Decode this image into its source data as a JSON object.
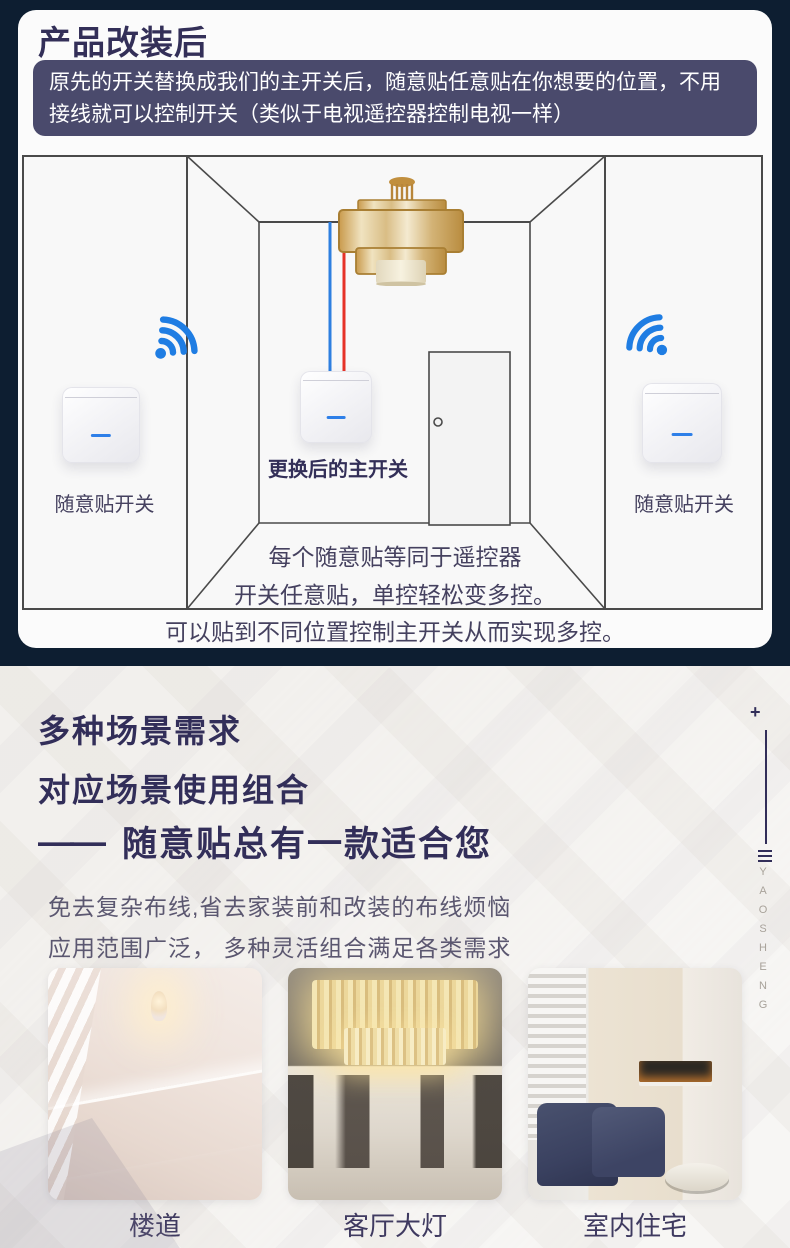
{
  "colors": {
    "page_navy": "#0d1e31",
    "card_bg": "#fbfbfb",
    "info_box_bg": "#4a4a6c",
    "heading_indigo": "#322e59",
    "body_gray": "#5b5770",
    "wifi_blue": "#1f7de3",
    "wire_live_red": "#e63228",
    "wire_neutral_blue": "#2e7fe0",
    "indicator_blue": "#2e7fe8"
  },
  "header": {
    "title": "产品改装后",
    "info_text": "原先的开关替换成我们的主开关后，随意贴任意贴在你想要的位置，不用接线就可以控制开关（类似于电视遥控器控制电视一样）"
  },
  "diagram": {
    "left_switch_label": "随意贴开关",
    "main_switch_label": "更换后的主开关",
    "right_switch_label": "随意贴开关",
    "captions": [
      "每个随意贴等同于遥控器",
      "开关任意贴，单控轻松变多控。",
      "可以贴到不同位置控制主开关从而实现多控。"
    ]
  },
  "scenes": {
    "heading_line1": "多种场景需求",
    "heading_line2": "对应场景使用组合",
    "tagline_dash": "——",
    "tagline": "随意贴总有一款适合您",
    "desc_line1": "免去复杂布线,省去家装前和改装的布线烦恼",
    "desc_line2": "应用范围广泛， 多种灵活组合满足各类需求",
    "photos": [
      {
        "caption": "楼道"
      },
      {
        "caption": "客厅大灯"
      },
      {
        "caption": "室内住宅"
      }
    ],
    "brand": {
      "plus": "+",
      "vertical_text": "YAOSHENG"
    }
  }
}
